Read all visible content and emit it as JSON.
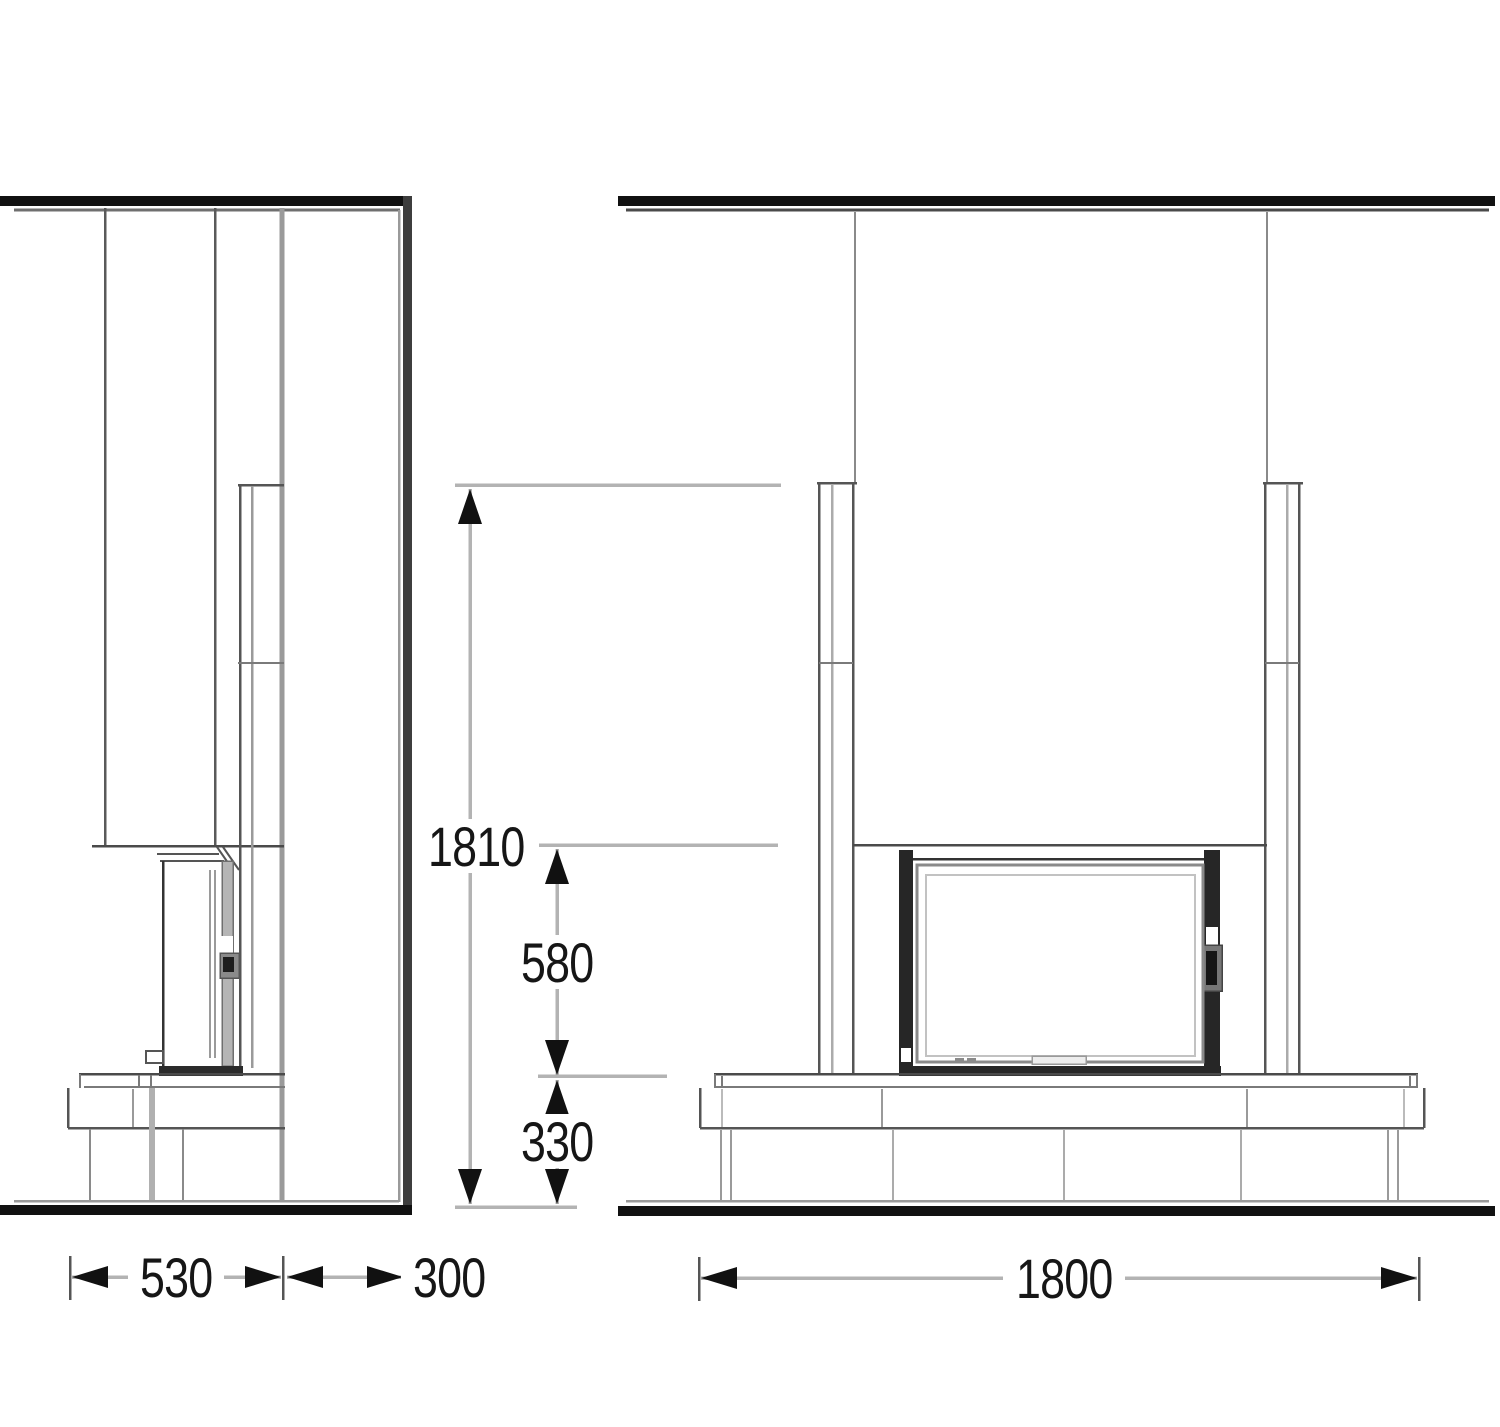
{
  "drawing": {
    "kind": "fireplace installation dimension drawing",
    "views": [
      "side elevation",
      "front elevation"
    ],
    "units_implied": "mm"
  },
  "dimensions": {
    "depth_front": "530",
    "depth_rear": "300",
    "width_total": "1800",
    "height_total": "1810",
    "height_opening": "580",
    "height_base": "330"
  },
  "colors": {
    "line_heavy": "#111111",
    "line_dark": "#4a4a4a",
    "line_mid": "#8a8a8a",
    "line_light": "#b3b3b3",
    "text": "#161616"
  }
}
